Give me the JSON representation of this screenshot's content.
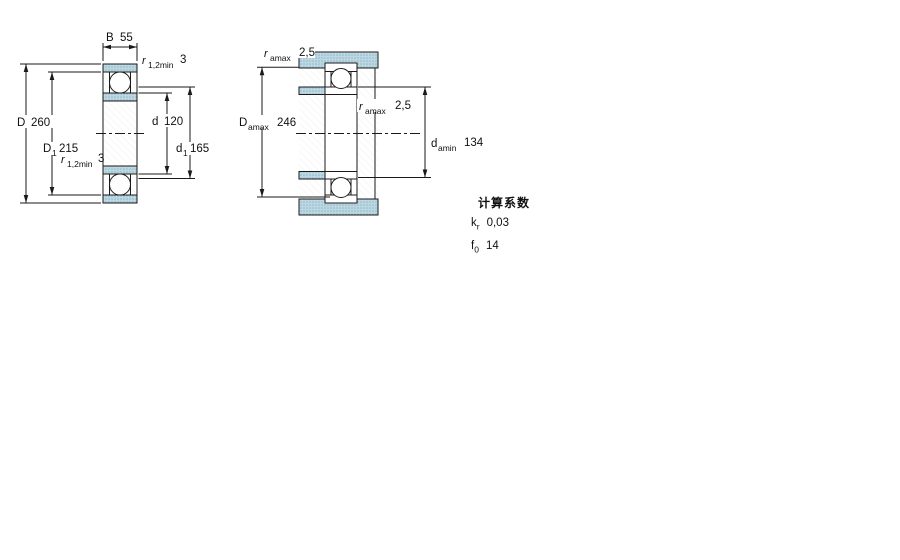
{
  "drawing": {
    "left_figure": {
      "dim_B": {
        "label": "B",
        "value": "55"
      },
      "dim_r_top": {
        "base": "r",
        "sub": "1,2min",
        "value": "3"
      },
      "dim_D": {
        "label": "D",
        "value": "260"
      },
      "dim_D1": {
        "base": "D",
        "sub": "1",
        "value": "215"
      },
      "dim_r_bottom": {
        "base": "r",
        "sub": "1,2min",
        "value": "3"
      },
      "dim_d": {
        "label": "d",
        "value": "120"
      },
      "dim_d1": {
        "base": "d",
        "sub": "1",
        "value": "165"
      }
    },
    "right_figure": {
      "dim_r_amax_top": {
        "base": "r",
        "sub": "amax",
        "value": "2,5"
      },
      "dim_D_amax": {
        "base": "D",
        "sub": "amax",
        "value": "246"
      },
      "dim_r_amax_mid": {
        "base": "r",
        "sub": "amax",
        "value": "2,5"
      },
      "dim_d_amin": {
        "base": "d",
        "sub": "amin",
        "value": "134"
      }
    },
    "colors": {
      "section_fill": "#bdd8e2",
      "section_dot": "#8fb8ca",
      "line": "#1a1a1a"
    }
  },
  "calculation_factors": {
    "title": "计算系数",
    "rows": [
      {
        "base": "k",
        "sub": "r",
        "value": "0,03"
      },
      {
        "base": "f",
        "sub": "0",
        "value": "14"
      }
    ]
  }
}
